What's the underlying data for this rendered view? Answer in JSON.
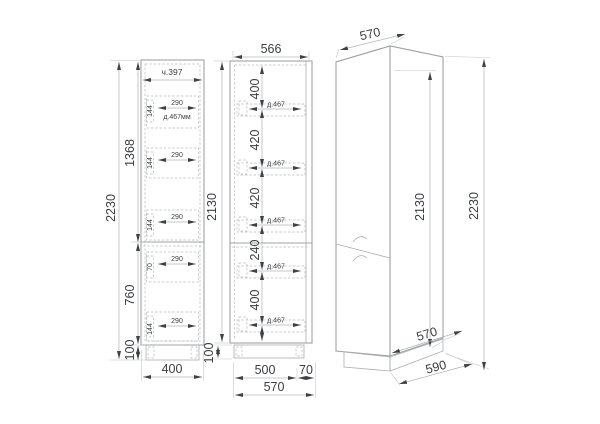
{
  "drawing": {
    "side_view": {
      "depth_note": "ч.397",
      "drawer_width": "290",
      "drawer_front_note": "д.467мм",
      "drawer_h_144": "144",
      "drawer_h_70": "70",
      "dim_total_height": "2230",
      "dim_upper": "1368",
      "dim_lower": "760",
      "dim_plinth": "100",
      "dim_width": "400"
    },
    "front_view": {
      "dim_top_width": "566",
      "dim_body_height": "2130",
      "dim_plinth": "100",
      "shelf_note": "д.467",
      "gap_top": "400",
      "gap_2": "420",
      "gap_3": "420",
      "gap_4": "240",
      "gap_bottom": "400",
      "dim_inner_width": "500",
      "dim_side_offset": "70",
      "dim_total_width": "570"
    },
    "iso_view": {
      "dim_top_width": "570",
      "dim_body_height": "2130",
      "dim_total_height": "2230",
      "dim_depth": "570",
      "dim_base_depth": "590"
    }
  }
}
